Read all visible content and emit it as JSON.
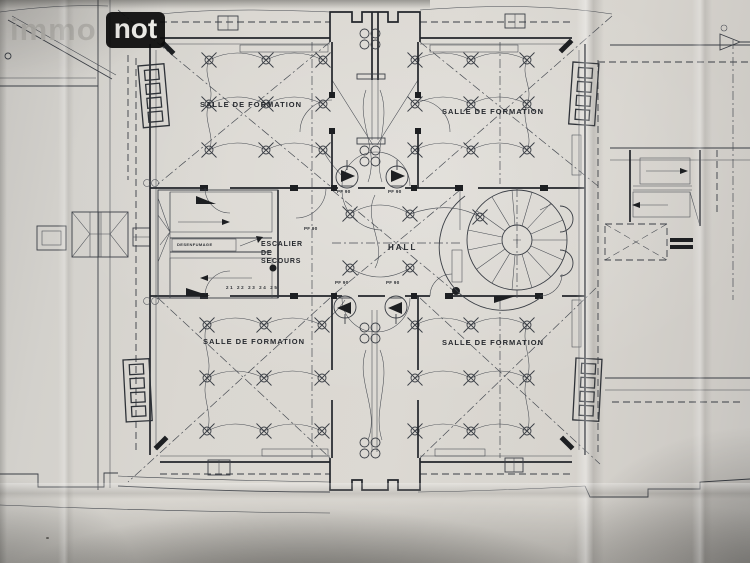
{
  "watermark": {
    "brand_light": "immo",
    "brand_badge": "not"
  },
  "plan": {
    "room_labels": {
      "top_left": "SALLE DE FORMATION",
      "top_right": "SALLE DE FORMATION",
      "bottom_left": "SALLE DE FORMATION",
      "bottom_right": "SALLE DE FORMATION"
    },
    "hall_label": "HALL",
    "emergency_stair_label": {
      "line1": "ESCALIER",
      "line2": "DE",
      "line3": "SECOURS"
    },
    "fire_door_label": "PF 90",
    "stair_note": "DESENFUMAGE",
    "stair_tread_numbers": "21 22 23 24 25"
  },
  "icons": {
    "ceiling_light": "circle-with-x-cross",
    "smoke_damper": "circle-with-black-flag",
    "service_outlet": "four-small-circles",
    "corner_turret": "stack-of-four-windows",
    "spiral_staircase": "radial-treads-circle"
  },
  "colors": {
    "paper": "#d8d5cf",
    "ink": "#3a3e45",
    "wall_ink": "#23262b",
    "shadow": "#55534f",
    "watermark_text": "#b7b5b0",
    "watermark_badge_bg": "#0c0c0c",
    "watermark_badge_text": "#f0efeb"
  }
}
